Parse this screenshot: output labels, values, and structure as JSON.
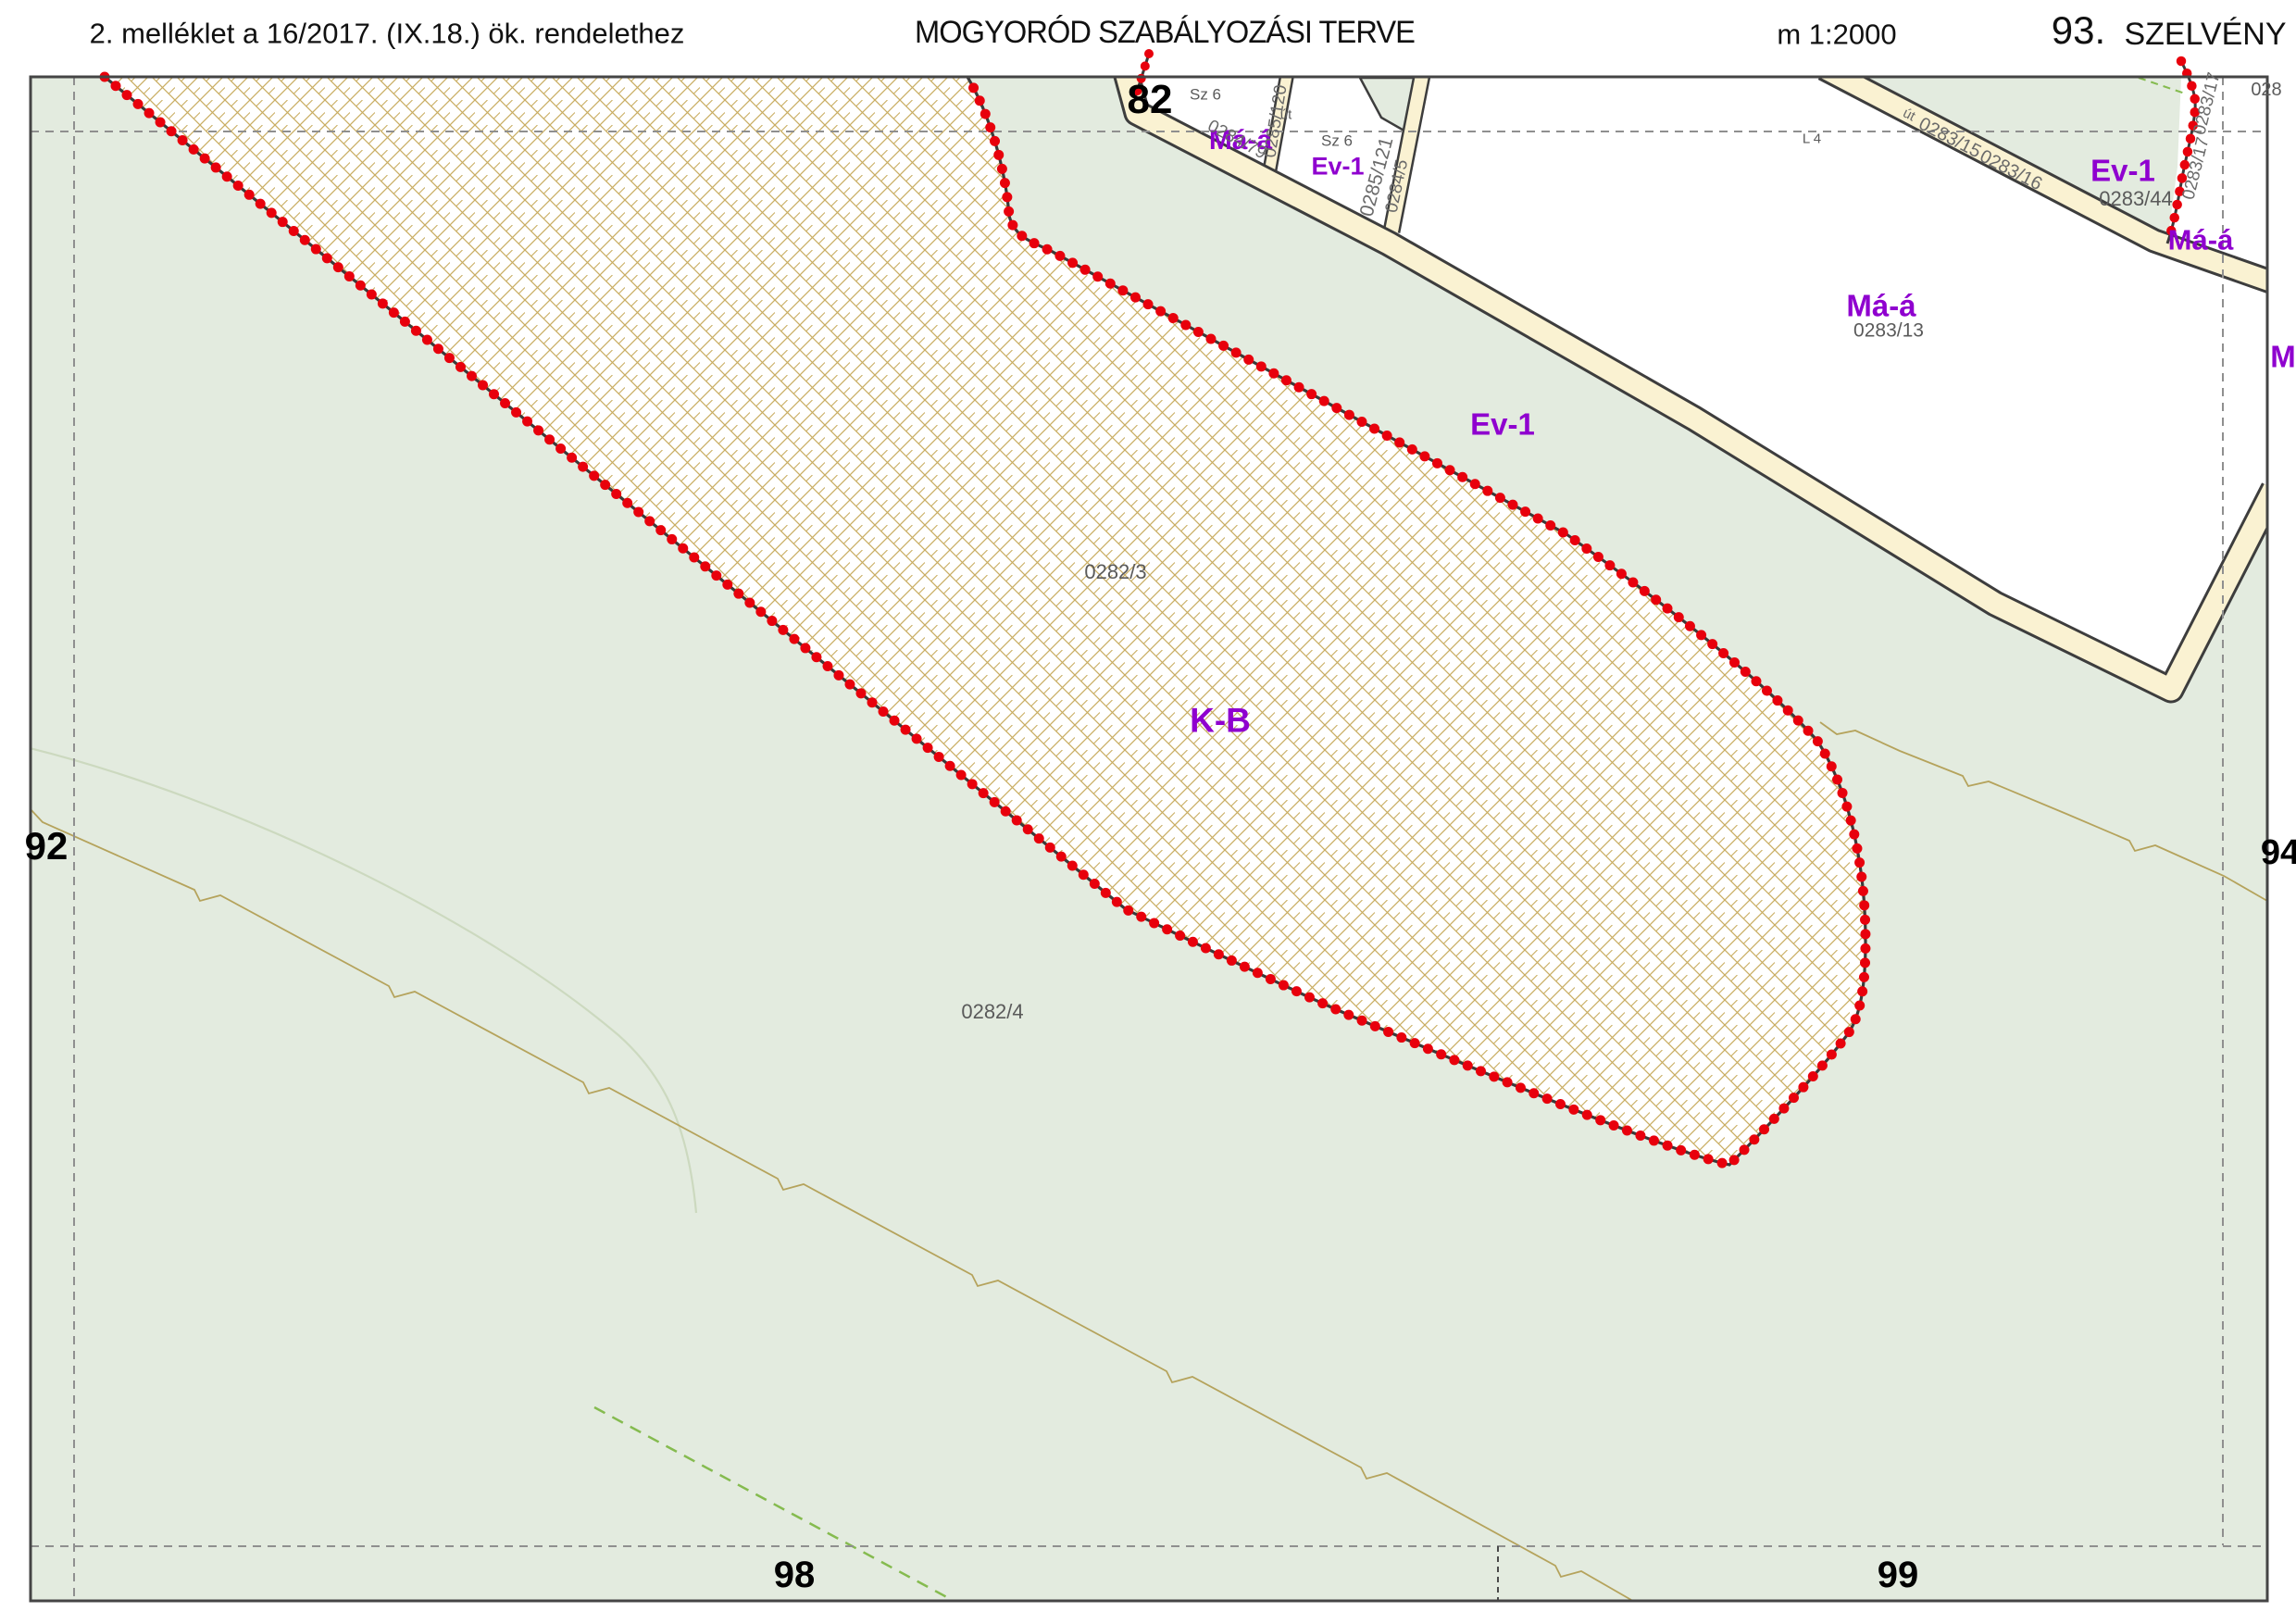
{
  "header": {
    "annex": "2. melléklet a 16/2017. (IX.18.) ök. rendelethez",
    "title": "MOGYORÓD SZABÁLYOZÁSI TERVE",
    "scale": "m 1:2000",
    "section_number": "93.",
    "section_label": "SZELVÉNY"
  },
  "grid_labels": {
    "top": "82",
    "left": "92",
    "right": "94",
    "bottom_left": "98",
    "bottom_right": "99"
  },
  "zones": {
    "kb": "K-B",
    "ev1_top": "Ev-1",
    "ev1_mid": "Ev-1",
    "ev1_right": "Ev-1",
    "maa_top": "Má-á",
    "maa_right": "Má-á",
    "maa_far_right": "Má-á",
    "maa_clipped": "M"
  },
  "parcels": {
    "p0282_3": "0282/3",
    "p0282_4": "0282/4",
    "p0283_44": "0283/44",
    "p0283_13": "0283/13",
    "p028_clipped": "028",
    "sz6_a": "Sz 6",
    "sz6_b": "Sz 6",
    "l4": "L 4",
    "ut_a": "út",
    "ut_b": "út",
    "r0285_120": "0285/120",
    "r0285_121": "0285/121",
    "r0284_5": "0284/5",
    "r0284_79": "0284/79",
    "r0283_15": "0283/15",
    "r0283_16": "0283/16",
    "r0283_17_a": "0283/17",
    "r0283_17_b": "0283/17"
  },
  "colors": {
    "zone_purple": "#8f00cf",
    "boundary_red": "#e8000c",
    "road_fill": "#faf2d2",
    "area_green": "#e3ebdf",
    "hatch_tan": "#c9ad62",
    "parcel_gray": "#5a5a5a"
  }
}
